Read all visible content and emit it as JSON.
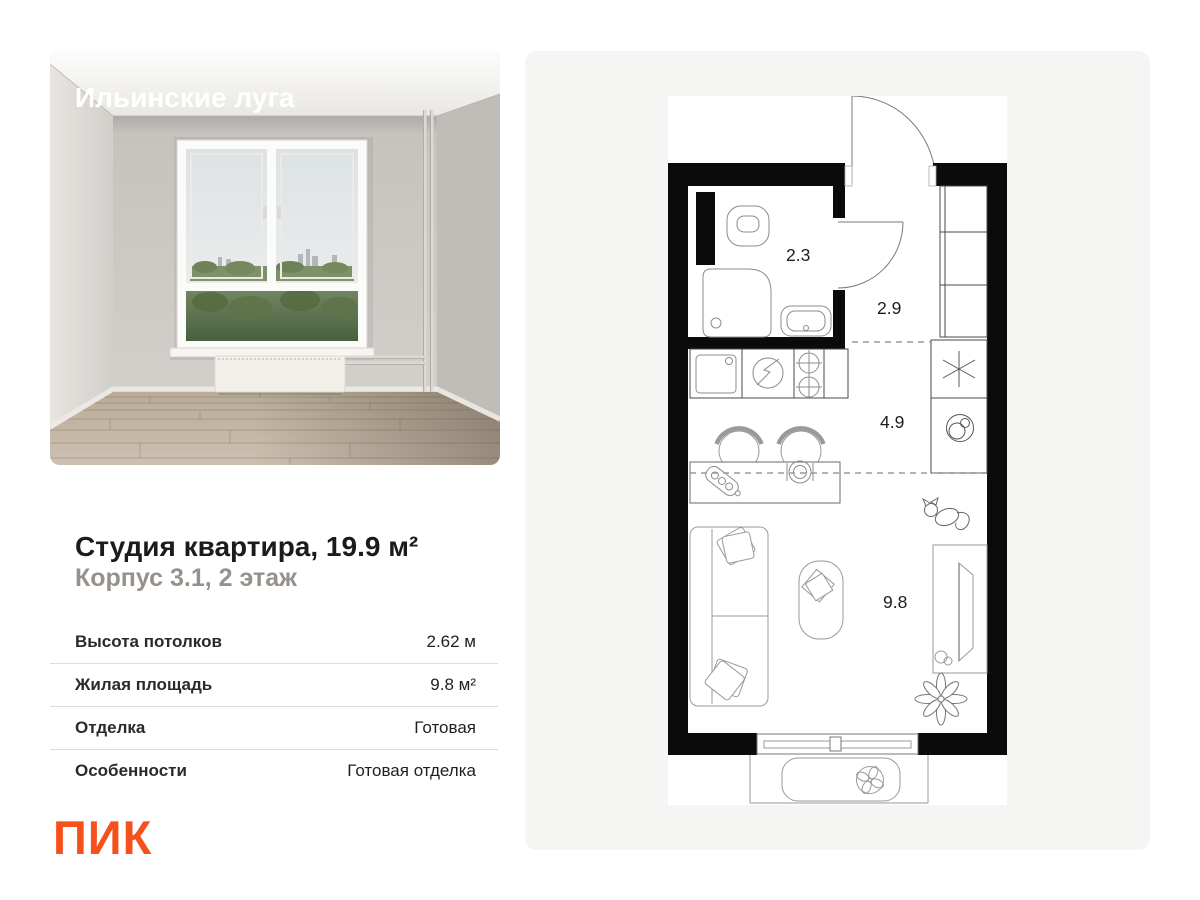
{
  "project": {
    "name": "Ильинские луга"
  },
  "listing": {
    "title": "Студия квартира, 19.9 м²",
    "subtitle": "Корпус 3.1, 2 этаж",
    "specs": [
      {
        "label": "Высота потолков",
        "value": "2.62 м"
      },
      {
        "label": "Жилая площадь",
        "value": "9.8 м²"
      },
      {
        "label": "Отделка",
        "value": "Готовая"
      },
      {
        "label": "Особенности",
        "value": "Готовая отделка"
      }
    ]
  },
  "brand": {
    "logo_text": "ПИК",
    "logo_color": "#f4511c"
  },
  "floorplan": {
    "rooms": [
      {
        "name": "bathroom",
        "area": "2.3"
      },
      {
        "name": "hallway",
        "area": "2.9"
      },
      {
        "name": "kitchen",
        "area": "4.9"
      },
      {
        "name": "living-room",
        "area": "9.8"
      }
    ],
    "colors": {
      "walls": "#0b0b0b",
      "plan_background": "#ffffff",
      "panel_background": "#f5f5f4"
    }
  }
}
